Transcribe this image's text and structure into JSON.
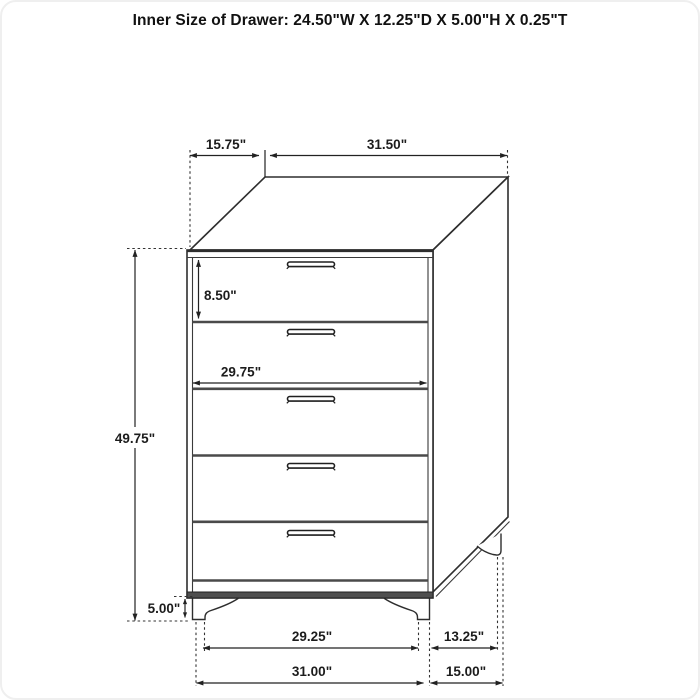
{
  "title": "Inner Size of Drawer: 24.50\"W X 12.25\"D X 5.00\"H X 0.25\"T",
  "figure": {
    "kind": "furniture-dimension-diagram",
    "item": "chest-of-drawers",
    "drawer_count": 5,
    "colors": {
      "line": "#2e2e2e",
      "divider": "#4a4a4a",
      "background": "#ffffff",
      "text": "#1c1c1c"
    }
  },
  "labels": {
    "top_depth": "15.75\"",
    "top_width": "31.50\"",
    "first_drawer_height": "8.50\"",
    "inner_width": "29.75\"",
    "overall_height": "49.75\"",
    "leg_height": "5.00\"",
    "base_inner_width": "29.25\"",
    "base_width": "31.00\"",
    "base_inner_depth": "13.25\"",
    "base_depth": "15.00\""
  }
}
